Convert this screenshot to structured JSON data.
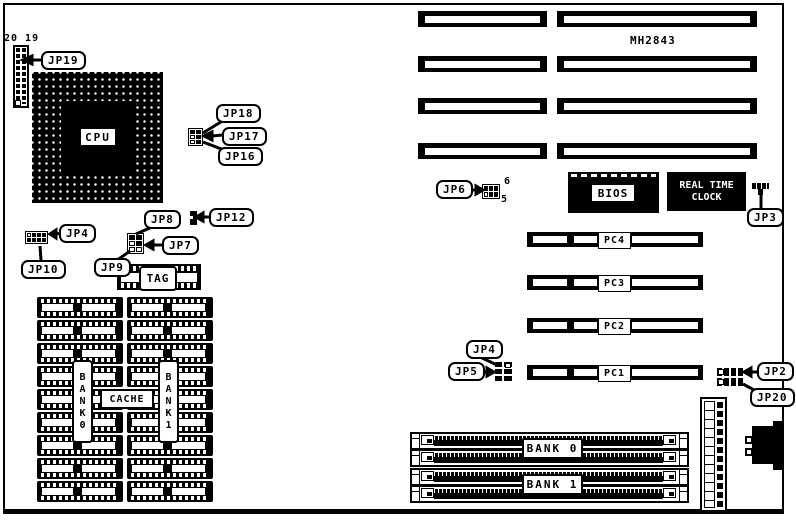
{
  "diagram": {
    "part_number": "MH2843",
    "jp19_pin_numbers": "20 19",
    "jp6_pin_top": "6",
    "jp6_pin_bottom": "5",
    "chips": {
      "cpu": "CPU",
      "bios": "BIOS",
      "rtc_line1": "REAL TIME",
      "rtc_line2": "CLOCK",
      "tag": "TAG",
      "cache": "CACHE"
    },
    "cache_banks": {
      "bank0": "BANK0",
      "bank1": "BANK1"
    },
    "simm_banks": {
      "bank0": "BANK 0",
      "bank1": "BANK 1"
    },
    "pc_slots": [
      "PC4",
      "PC3",
      "PC2",
      "PC1"
    ],
    "callouts": {
      "jp19": "JP19",
      "jp18": "JP18",
      "jp17": "JP17",
      "jp16": "JP16",
      "jp12": "JP12",
      "jp8": "JP8",
      "jp7": "JP7",
      "jp9": "JP9",
      "jp4_left": "JP4",
      "jp10": "JP10",
      "jp6": "JP6",
      "jp3": "JP3",
      "jp4_right": "JP4",
      "jp5": "JP5",
      "jp2": "JP2",
      "jp20": "JP20"
    }
  }
}
